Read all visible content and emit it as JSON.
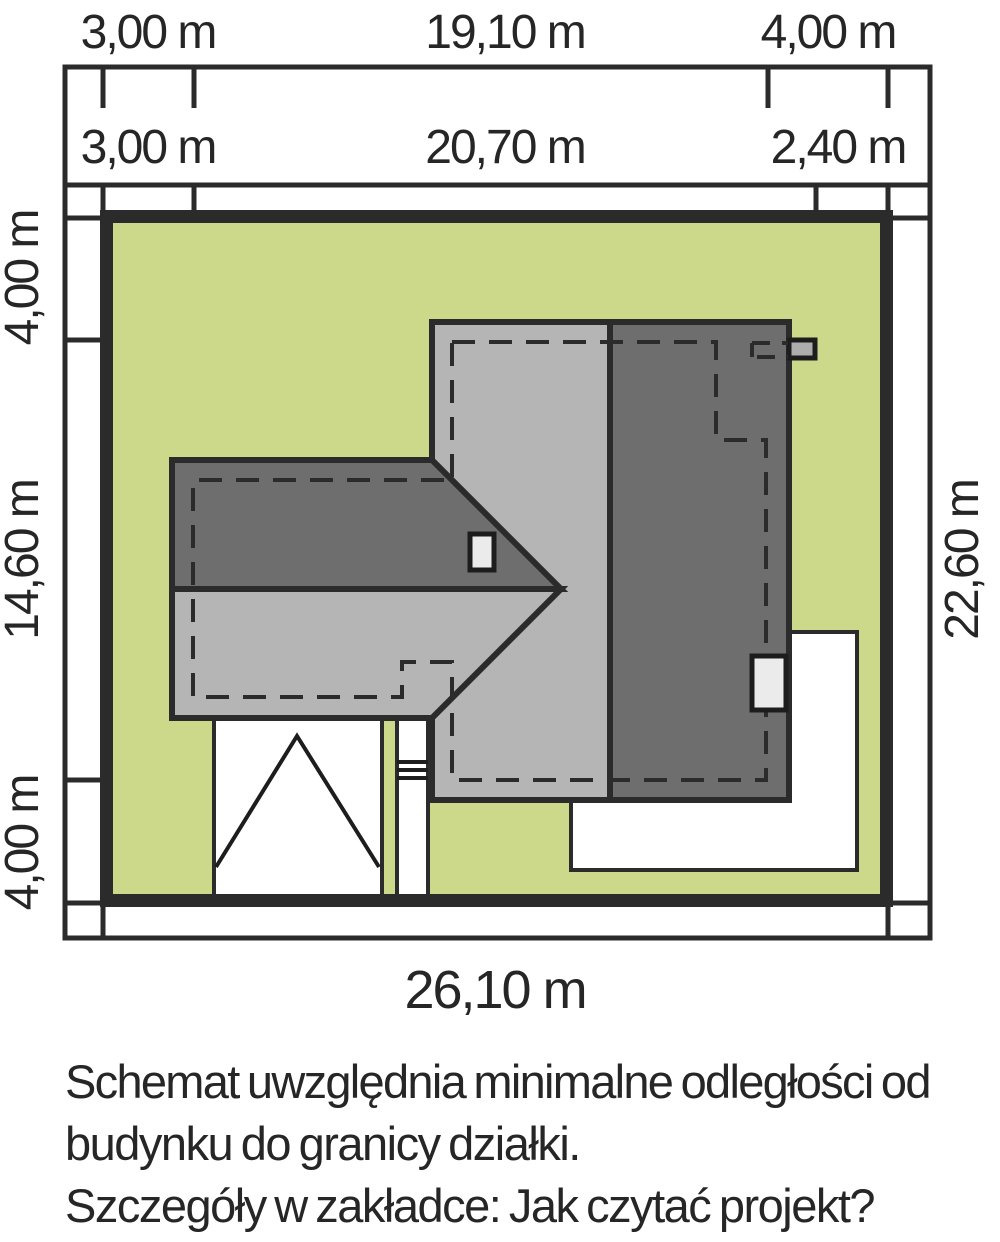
{
  "diagram_title": "site-plan-scheme",
  "dims": {
    "top_row1_left": "3,00 m",
    "top_row1_mid": "19,10 m",
    "top_row1_right": "4,00 m",
    "top_row2_left": "3,00 m",
    "top_row2_mid": "20,70 m",
    "top_row2_right": "2,40 m",
    "left_top": "4,00 m",
    "left_mid": "14,60 m",
    "left_bottom": "4,00 m",
    "right_full": "22,60 m",
    "bottom_full": "26,10 m"
  },
  "note": {
    "line1": "Schemat uwzględnia minimalne odległości od",
    "line2": "budynku do granicy działki.",
    "line3": "Szczegóły w zakładce: Jak czytać projekt?"
  },
  "colors": {
    "grass": "#ccd88a",
    "roof_light": "#b5b5b5",
    "roof_dark": "#6e6e6e",
    "outline": "#2b2b2b",
    "panel_light": "#ebebeb",
    "vent_gray": "#adadad",
    "paper": "#ffffff"
  }
}
